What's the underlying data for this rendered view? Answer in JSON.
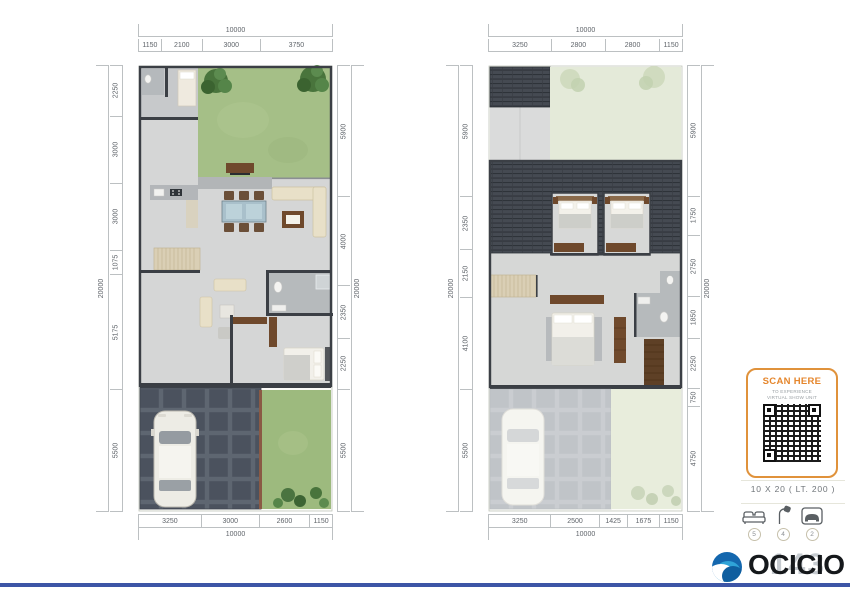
{
  "accent": {
    "orange": "#E0923B",
    "bottom_bar_blue": "#3D55A6",
    "logo_blue": "#1467AE"
  },
  "qr_card": {
    "title": "SCAN HERE",
    "subtitle_line1": "TO EXPERIENCE",
    "subtitle_line2": "VIRTUAL SHOW UNIT"
  },
  "unit_spec": {
    "label": "10 X 20  ( LT. 200 )"
  },
  "features": [
    {
      "icon": "bed-icon",
      "count": "5"
    },
    {
      "icon": "shower-icon",
      "count": "4"
    },
    {
      "icon": "car-icon",
      "count": "2"
    }
  ],
  "logo": {
    "text": "OCICIO",
    "ghost_text": "143"
  },
  "plans": [
    {
      "dims": {
        "top_total": 10000,
        "top": [
          1150,
          2100,
          3000,
          3750
        ],
        "left_total": 20000,
        "left": [
          2250,
          3000,
          3000,
          1075,
          5175,
          5500
        ],
        "right_total": 20000,
        "right": [
          5900,
          4000,
          2350,
          2250,
          5500
        ],
        "bottom_total": 10000,
        "bottom": [
          3250,
          3000,
          2600,
          1150
        ]
      }
    },
    {
      "dims": {
        "top_total": 10000,
        "top": [
          3250,
          2800,
          2800,
          1150
        ],
        "left_total": 20000,
        "left": [
          5900,
          2350,
          2150,
          4100,
          5500
        ],
        "right_total": 20000,
        "right": [
          5900,
          1750,
          2750,
          1850,
          2250,
          750,
          4750
        ],
        "bottom_total": 10000,
        "bottom": [
          3250,
          2500,
          1425,
          1675,
          1150
        ]
      }
    }
  ]
}
